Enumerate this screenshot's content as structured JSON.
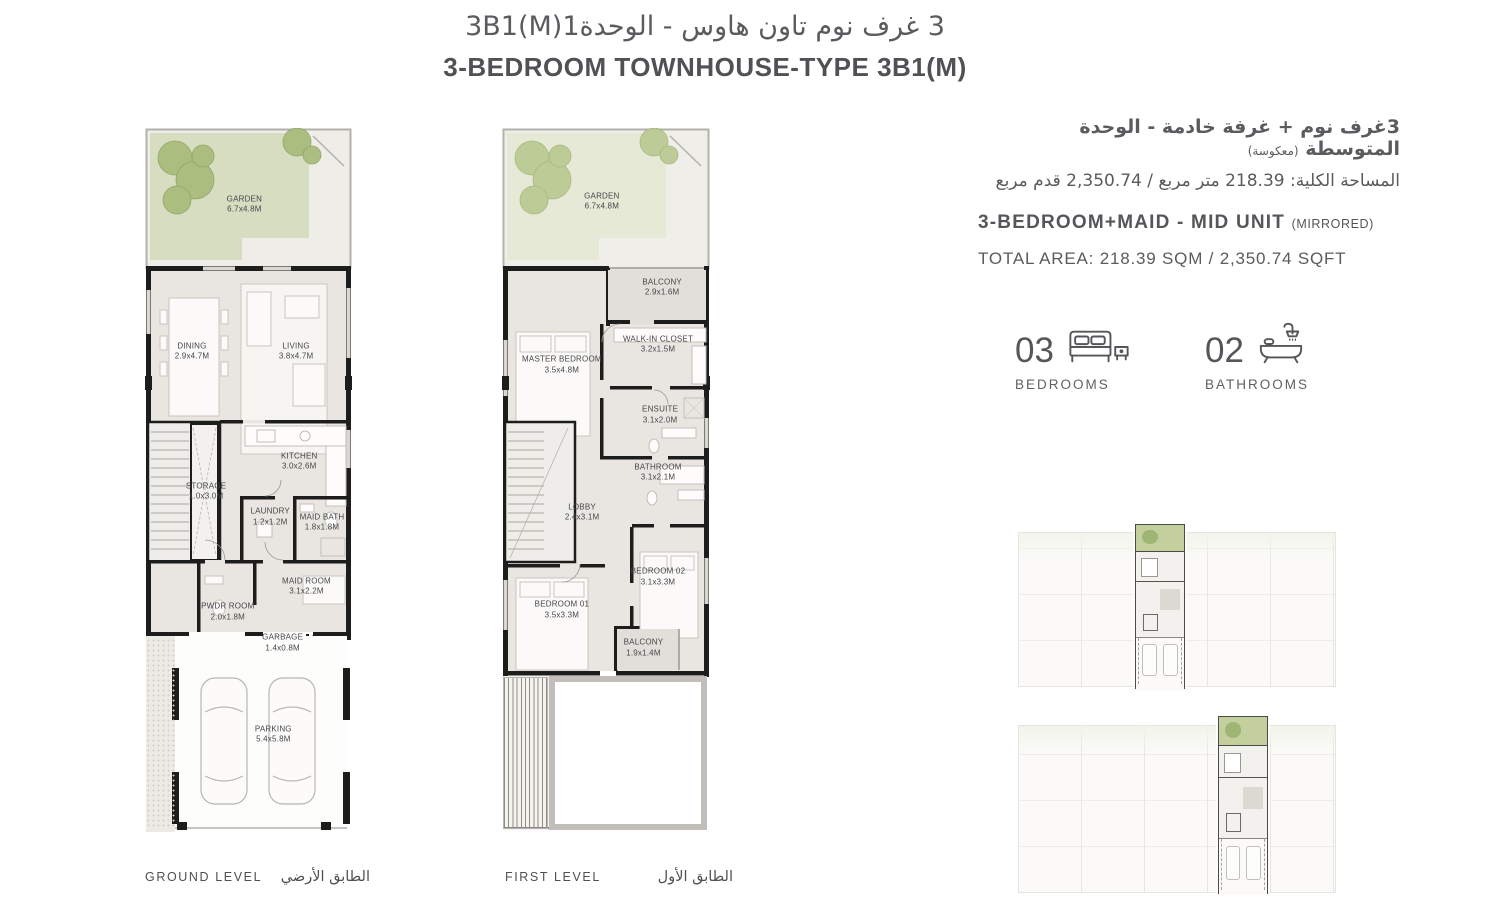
{
  "palette": {
    "text_dark": "#55565a",
    "text_mid": "#6d6e71",
    "wall_black": "#1d1d1b",
    "floor": "#e9e6e1",
    "garden_green_ground": "#d7ddc0",
    "garden_green_first": "#e5e9d6",
    "tree_green": "#a9bd7d",
    "key_plan_highlight_green": "#c3cf9d"
  },
  "header": {
    "title_ar": "3 غرف نوم تاون هاوس - الوحدة3B1(M)1",
    "title_en": "3-BEDROOM TOWNHOUSE-TYPE 3B1(M)"
  },
  "info": {
    "ar_line1": "3غرف نوم + غرفة خادمة - الوحدة المتوسطة",
    "ar_line1_note": "(معكوسة)",
    "ar_line2": "المساحة الكلية: 218.39 متر مربع / 2,350.74 قدم مربع",
    "en_line1": "3-BEDROOM+MAID - MID UNIT",
    "en_line1_note": "(MIRRORED)",
    "en_line2": "TOTAL AREA: 218.39 SQM / 2,350.74 SQFT"
  },
  "stats": {
    "bedrooms_count": "03",
    "bedrooms_label": "BEDROOMS",
    "bathrooms_count": "02",
    "bathrooms_label": "BATHROOMS"
  },
  "plans": {
    "ground": {
      "label_en": "GROUND LEVEL",
      "label_ar": "الطابق الأرضي",
      "rooms": [
        {
          "name": "GARDEN",
          "dims": "6.7x4.8M",
          "x": 48,
          "y": 10.9
        },
        {
          "name": "DINING",
          "dims": "2.9x4.7M",
          "x": 22.7,
          "y": 31.8
        },
        {
          "name": "LIVING",
          "dims": "3.8x4.7M",
          "x": 73,
          "y": 31.8
        },
        {
          "name": "KITCHEN",
          "dims": "3.0x2.6M",
          "x": 74.5,
          "y": 47.4
        },
        {
          "name": "STORAGE",
          "dims": "1.0x3.0M",
          "x": 29.5,
          "y": 51.7
        },
        {
          "name": "LAUNDRY",
          "dims": "1.2x1.2M",
          "x": 60.5,
          "y": 55.3
        },
        {
          "name": "MAID BATH",
          "dims": "1.8x1.8M",
          "x": 85.5,
          "y": 56.1
        },
        {
          "name": "MAID ROOM",
          "dims": "3.1x2.2M",
          "x": 78,
          "y": 65.2
        },
        {
          "name": "PWDR ROOM",
          "dims": "2.0x1.8M",
          "x": 40,
          "y": 68.8
        },
        {
          "name": "GARBAGE",
          "dims": "1.4x0.8M",
          "x": 66.5,
          "y": 73.2
        },
        {
          "name": "PARKING",
          "dims": "5.4x5.8M",
          "x": 62,
          "y": 86.2
        }
      ]
    },
    "first": {
      "label_en": "FIRST LEVEL",
      "label_ar": "الطابق الأول",
      "rooms": [
        {
          "name": "GARDEN",
          "dims": "6.7x4.8M",
          "x": 48,
          "y": 10.5
        },
        {
          "name": "BALCONY",
          "dims": "2.9x1.6M",
          "x": 77,
          "y": 22.7
        },
        {
          "name": "WALK-IN CLOSET",
          "dims": "3.2x1.5M",
          "x": 75,
          "y": 30.8
        },
        {
          "name": "MASTER BEDROOM",
          "dims": "3.5x4.8M",
          "x": 28.8,
          "y": 33.7
        },
        {
          "name": "ENSUITE",
          "dims": "3.1x2.0M",
          "x": 76,
          "y": 40.8
        },
        {
          "name": "BATHROOM",
          "dims": "3.1x2.1M",
          "x": 75,
          "y": 49.0
        },
        {
          "name": "LOBBY",
          "dims": "2.4x3.1M",
          "x": 38.5,
          "y": 54.7
        },
        {
          "name": "BEDROOM 02",
          "dims": "3.1x3.3M",
          "x": 75,
          "y": 63.8
        },
        {
          "name": "BEDROOM 01",
          "dims": "3.5x3.3M",
          "x": 28.8,
          "y": 68.5
        },
        {
          "name": "BALCONY",
          "dims": "1.9x1.4M",
          "x": 68,
          "y": 73.9
        }
      ]
    }
  },
  "key_plans": [
    {
      "id": "kp-unit-upper",
      "left": 36.8,
      "width": 15.7
    },
    {
      "id": "kp-unit-lower",
      "left": 63.0,
      "width": 15.7
    }
  ]
}
